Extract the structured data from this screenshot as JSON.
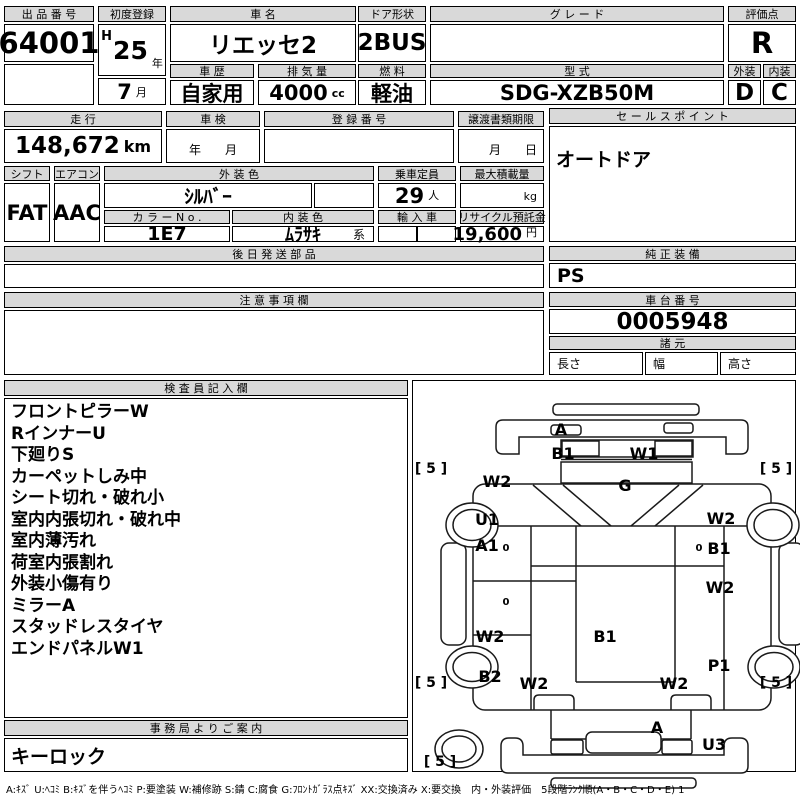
{
  "top": {
    "auction_no_label": "出 品 番 号",
    "auction_no": "64001",
    "first_reg_label": "初度登録",
    "era": "H",
    "reg_year": "25",
    "year_unit": "年",
    "reg_month": "7",
    "month_unit": "月",
    "car_name_label": "車 名",
    "car_name": "リエッセ2",
    "door_label": "ドア形状",
    "door": "2BUS",
    "grade_label": "グ レ ー ド",
    "grade": "",
    "score_label": "評価点",
    "score": "R",
    "history_label": "車 歴",
    "history": "自家用",
    "displacement_label": "排 気 量",
    "displacement": "4000",
    "displacement_unit": "cc",
    "fuel_label": "燃 料",
    "fuel": "軽油",
    "model_label": "型 式",
    "model": "SDG-XZB50M",
    "exterior_label": "外装",
    "exterior_score": "D",
    "interior_label": "内装",
    "interior_score": "C"
  },
  "mid": {
    "mileage_label": "走 行",
    "mileage": "148,672",
    "mileage_unit": "km",
    "inspection_label": "車 検",
    "inspection_placeholder": "年　　月",
    "reg_no_label": "登 録 番 号",
    "reg_no": "",
    "transfer_label": "譲渡書類期限",
    "transfer_placeholder": "月　　日",
    "sales_label": "セ ー ル ス ポ イ ン ト",
    "sales_point": "オートドア",
    "shift_label": "シフト",
    "shift": "FAT",
    "aircon_label": "エアコン",
    "aircon": "AAC",
    "ext_color_label": "外 装 色",
    "ext_color": "ｼﾙﾊﾞｰ",
    "color_no_label": "カ ラ ー N o .",
    "color_no": "1E7",
    "int_color_label": "内 装 色",
    "int_color": "ﾑﾗｻｷ",
    "int_color_suffix": "系",
    "capacity_label": "乗車定員",
    "capacity": "29",
    "capacity_unit": "人",
    "max_load_label": "最大積載量",
    "max_load": "",
    "max_load_unit": "kg",
    "import_label": "輸 入 車",
    "recycle_label": "リサイクル預託金",
    "recycle": "19,600",
    "recycle_unit": "円"
  },
  "sections": {
    "later_parts_label": "後 日 発 送 部 品",
    "later_parts": "",
    "genuine_label": "純 正 装 備",
    "genuine": "PS",
    "notes_label": "注 意 事 項 欄",
    "notes": "",
    "chassis_label": "車 台 番 号",
    "chassis_no": "0005948",
    "spec_label": "諸 元",
    "length_label": "長さ",
    "width_label": "幅",
    "height_label": "高さ",
    "inspector_label": "検 査 員 記 入 欄",
    "inspector_notes": [
      "フロントピラーW",
      "RインナーU",
      "下廻りS",
      "カーペットしみ中",
      "シート切れ・破れ小",
      "室内内張切れ・破れ中",
      "室内薄汚れ",
      "荷室内張割れ",
      "外装小傷有り",
      "ミラーA",
      "スタッドレスタイヤ",
      "エンドパネルW1"
    ],
    "office_label": "事 務 局 よ り ご 案 内",
    "office_note": "キーロック"
  },
  "diagram": {
    "labels": [
      {
        "text": "A",
        "x": 148,
        "y": 49
      },
      {
        "text": "B1",
        "x": 150,
        "y": 73
      },
      {
        "text": "W1",
        "x": 231,
        "y": 73
      },
      {
        "text": "[ 5 ]",
        "x": 18,
        "y": 88,
        "bracket": true
      },
      {
        "text": "[ 5 ]",
        "x": 363,
        "y": 88,
        "bracket": true
      },
      {
        "text": "W2",
        "x": 84,
        "y": 101
      },
      {
        "text": "G",
        "x": 212,
        "y": 105
      },
      {
        "text": "U1",
        "x": 74,
        "y": 139
      },
      {
        "text": "W2",
        "x": 308,
        "y": 138
      },
      {
        "text": "A1",
        "x": 74,
        "y": 165
      },
      {
        "text": "0",
        "x": 93,
        "y": 168,
        "small": true
      },
      {
        "text": "0",
        "x": 286,
        "y": 168,
        "small": true
      },
      {
        "text": "B1",
        "x": 306,
        "y": 168
      },
      {
        "text": "0",
        "x": 93,
        "y": 222,
        "small": true
      },
      {
        "text": "W2",
        "x": 307,
        "y": 207
      },
      {
        "text": "W2",
        "x": 77,
        "y": 256
      },
      {
        "text": "B1",
        "x": 192,
        "y": 256
      },
      {
        "text": "B2",
        "x": 77,
        "y": 296
      },
      {
        "text": "P1",
        "x": 306,
        "y": 285
      },
      {
        "text": "W2",
        "x": 121,
        "y": 303
      },
      {
        "text": "W2",
        "x": 261,
        "y": 303
      },
      {
        "text": "[ 5 ]",
        "x": 18,
        "y": 302,
        "bracket": true
      },
      {
        "text": "[ 5 ]",
        "x": 363,
        "y": 302,
        "bracket": true
      },
      {
        "text": "A",
        "x": 244,
        "y": 347
      },
      {
        "text": "U3",
        "x": 301,
        "y": 364
      },
      {
        "text": "[ 5 ]",
        "x": 27,
        "y": 381,
        "bracket": true
      }
    ]
  },
  "legend": "A:ｷｽﾞ U:ﾍｺﾐ B:ｷｽﾞを伴うﾍｺﾐ P:要塗装 W:補修跡 S:錆 C:腐食 G:ﾌﾛﾝﾄｶﾞﾗｽ点ｷｽﾞ XX:交換済み X:要交換　内・外装評価　5段階ﾗﾝｸ順(A・B・C・D・E) 1"
}
